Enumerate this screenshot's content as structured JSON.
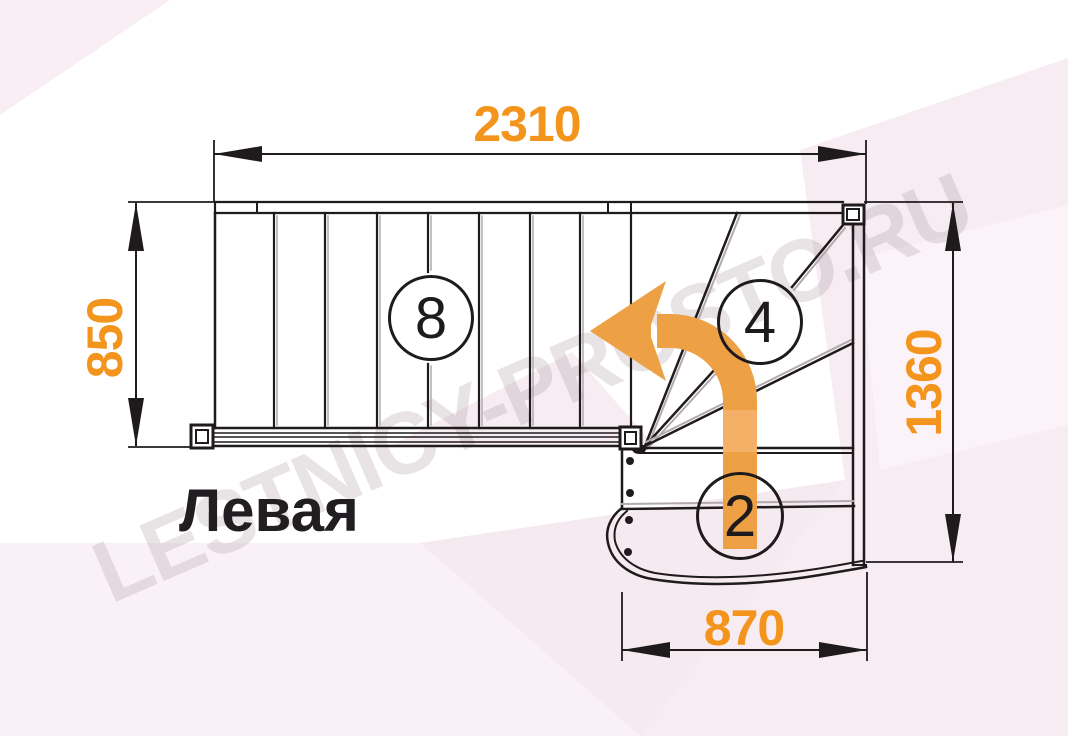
{
  "watermark": {
    "text": "LESTNICY-PROSTO.RU"
  },
  "title": {
    "label": "Левая"
  },
  "dimensions": {
    "top": {
      "value": "2310"
    },
    "left": {
      "value": "850"
    },
    "right": {
      "value": "1360"
    },
    "bottom": {
      "value": "870"
    }
  },
  "step_counts": {
    "straight_flight": "8",
    "winders": "4",
    "lower_flight": "2"
  },
  "colors": {
    "dimension": "#f3941d",
    "arrow": "#eda044",
    "arrow-light": "#f3b066",
    "line": "#1f1b1d",
    "shadow": "#b3aaae",
    "tint1": "#f8eef3",
    "tint2": "#f6ebf1",
    "tint3": "#faf1f6",
    "watermark": "rgba(150,130,142,0.22)"
  }
}
